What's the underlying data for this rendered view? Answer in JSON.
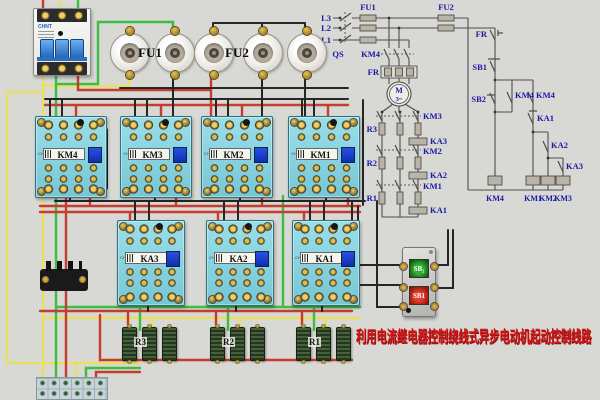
{
  "title": {
    "text": "利用电流继电器控制绕线式异步电动机起动控制线路"
  },
  "devices": {
    "brand": "CHNT",
    "breaker": {
      "brand": "CHNT"
    },
    "fuse_groups": [
      {
        "label": "FU1"
      },
      {
        "label": "FU2"
      }
    ],
    "contactors": [
      {
        "label": "KM4"
      },
      {
        "label": "KM3"
      },
      {
        "label": "KM2"
      },
      {
        "label": "KM1"
      }
    ],
    "relays": [
      {
        "label": "KA3"
      },
      {
        "label": "KA2"
      },
      {
        "label": "KA1"
      }
    ],
    "resistors": [
      {
        "label": "R3"
      },
      {
        "label": "R2"
      },
      {
        "label": "R1"
      }
    ],
    "button_station": {
      "start": "SB₂",
      "stop": "SB1"
    }
  },
  "schematic": {
    "phases": [
      "L3",
      "L2",
      "L1"
    ],
    "qs": "QS",
    "fu1": "FU1",
    "fu2": "FU2",
    "km4_main": "KM4",
    "fr_main": "FR",
    "motor": {
      "name": "M",
      "phase": "3~"
    },
    "rotor": {
      "km3": "KM3",
      "r3": "R3",
      "ka3": "KA3",
      "km2": "KM2",
      "r2": "R2",
      "ka2": "KA2",
      "km1": "KM1",
      "r1": "R1",
      "ka1": "KA1"
    },
    "control": {
      "fr": "FR",
      "sb1": "SB1",
      "sb2": "SB2",
      "km4_a": "KM4",
      "km4_b": "KM4",
      "ka1": "KA1",
      "ka2": "KA2",
      "ka3": "KA3",
      "coil_km4": "KM4",
      "coil_km1": "KM1",
      "coil_km2": "KM2",
      "coil_km3": "KM3"
    }
  },
  "colors": {
    "wire_red": "#c63c31",
    "wire_yellow": "#e8df64",
    "wire_green": "#3dbd41",
    "wire_black": "#262626",
    "schematic_label": "#1a1aa6",
    "title_red": "#cf1717",
    "device_body": "#8fd8e4"
  }
}
